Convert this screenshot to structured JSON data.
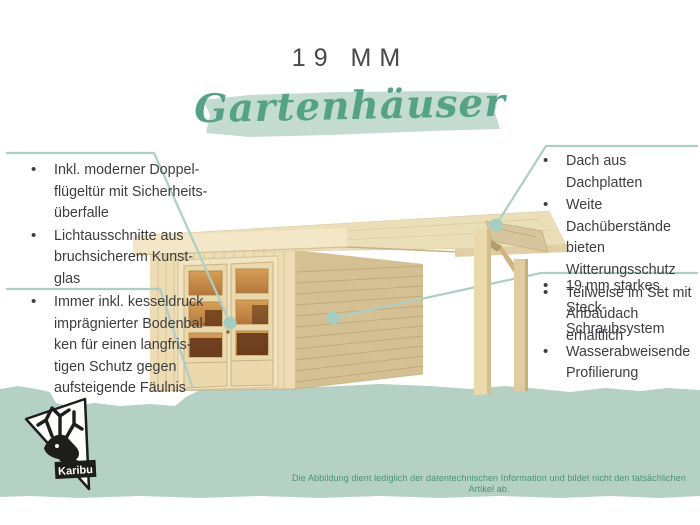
{
  "header": {
    "size_label": "19 MM",
    "category_title": "Gartenhäuser"
  },
  "callouts": {
    "left_top": {
      "items": [
        "Inkl. moderner Doppel-\nflügeltür mit Sicherheits-\nüberfalle",
        "Lichtausschnitte aus\nbruchsicherem Kunst-\nglas"
      ]
    },
    "left_bottom": {
      "items": [
        "Immer inkl. kesseldruck\nimprägnierter Bodenbal-\nken für einen langfris-\ntigen Schutz gegen\naufsteigende Fäulnis"
      ]
    },
    "right_top": {
      "items": [
        "Dach aus Dachplatten",
        "Weite Dachüberstände\nbieten Witterungsschutz",
        "Teilweise im Set mit\nAnbaudach erhältlich"
      ]
    },
    "right_bottom": {
      "items": [
        "19 mm starkes Steck-\nSchraubsystem",
        "Wasserabweisende\nProfilierung"
      ]
    }
  },
  "logo": {
    "brand": "Karibu",
    "icon": "deer-head-icon"
  },
  "footer": {
    "disclaimer": "Die Abbildung dient lediglich der datentechnischen Information und bildet nicht den tatsächlichen Artikel ab."
  },
  "colors": {
    "accent_green": "#55a287",
    "brush_green": "#c3dbd0",
    "band_green": "#b5d1c5",
    "leader_line": "#accfc5",
    "body_text": "#3c3d41",
    "fineprint_green": "#48917a",
    "wood_light": "#eedcb5",
    "wood_mid": "#d5c094",
    "glass_amber": "#c98f4e"
  }
}
